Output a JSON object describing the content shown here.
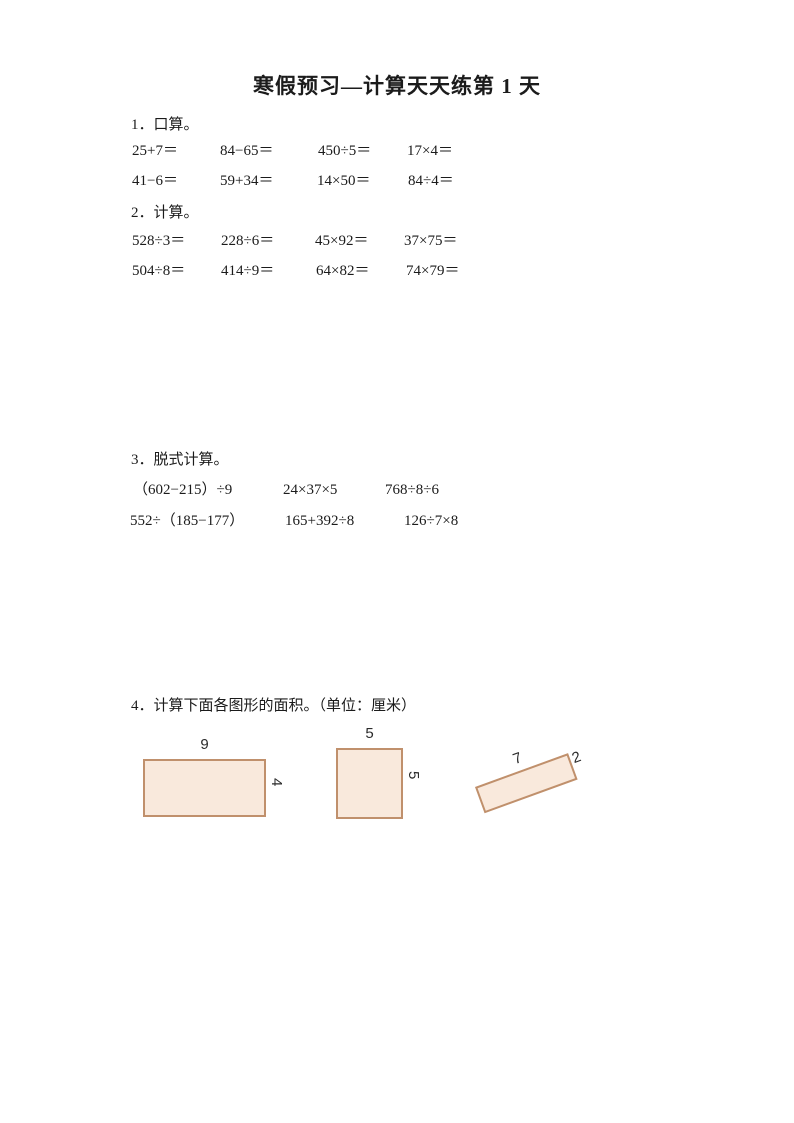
{
  "page": {
    "title": "寒假预习—计算天天练第 1 天"
  },
  "sections": {
    "oral": {
      "heading": "1．口算。",
      "rows": [
        [
          "25+7＝",
          "84−65＝",
          "450÷5＝",
          "17×4＝"
        ],
        [
          "41−6＝",
          "59+34＝",
          "14×50＝",
          "84÷4＝"
        ]
      ]
    },
    "written": {
      "heading": "2．计算。",
      "rows": [
        [
          "528÷3＝",
          "228÷6＝",
          "45×92＝",
          "37×75＝"
        ],
        [
          "504÷8＝",
          "414÷9＝",
          "64×82＝",
          "74×79＝"
        ]
      ]
    },
    "stepwise": {
      "heading": "3．脱式计算。",
      "rows": [
        [
          "（602−215）÷9",
          "24×37×5",
          "768÷8÷6"
        ],
        [
          "552÷（185−177）",
          "165+392÷8",
          "126÷7×8"
        ]
      ]
    },
    "area": {
      "heading": "4．计算下面各图形的面积。（单位：厘米）",
      "shapes": [
        {
          "type": "rectangle",
          "top_label": "9",
          "side_label": "4"
        },
        {
          "type": "square",
          "top_label": "5",
          "side_label": "5"
        },
        {
          "type": "rotated-rectangle",
          "long_side_label": "7",
          "short_side_label": "2"
        }
      ],
      "fill_color": "#F9E9DC",
      "border_color": "#C0906C"
    }
  }
}
